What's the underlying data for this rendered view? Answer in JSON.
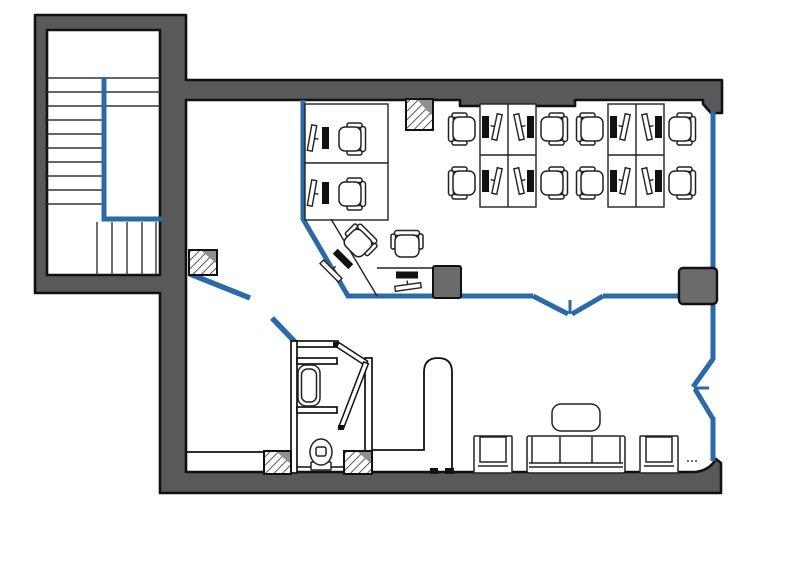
{
  "document": {
    "type": "architectural-floor-plan",
    "background": "#ffffff"
  },
  "colors": {
    "exterior_wall_fill": "#595959",
    "wall_outline": "#111111",
    "partition_blue": "#2A6AA6",
    "furniture_stroke": "#222222",
    "keyboard_fill": "#111111",
    "cabinet_fill": "#6b6b6b",
    "column_corner_gray": "#8f8f8f"
  },
  "elements": {
    "staircase": {
      "upper_treads": 3,
      "side_treads": 7,
      "bottom_treads": 6,
      "handrail_color": "#2A6AA6"
    },
    "office": {
      "workstation_clusters": 2,
      "workstations_per_cluster": 4,
      "wall_desks": 2,
      "corner_workstations": 2,
      "office_chairs_total": 12,
      "monitors_total": 12,
      "keyboards_total": 12
    },
    "lounge": {
      "sofas": 1,
      "sofa_seats": 3,
      "armchairs": 2,
      "coffee_tables": 1
    },
    "bathroom": {
      "sinks": 1,
      "toilets": 1,
      "bifold_doors": 1
    },
    "structure": {
      "hatched_columns": 4,
      "gray_columns": 1,
      "storage_cabinets": 1,
      "double_swing_doors": 2,
      "entry_door_leaves": 2,
      "curved_partitions": 1
    }
  },
  "icon_names": [
    "office-chair-icon",
    "monitor-icon",
    "keyboard-icon",
    "sofa-icon",
    "armchair-icon",
    "coffee-table-icon",
    "toilet-icon",
    "sink-icon",
    "door-leaf-icon",
    "column-hatched-icon"
  ]
}
